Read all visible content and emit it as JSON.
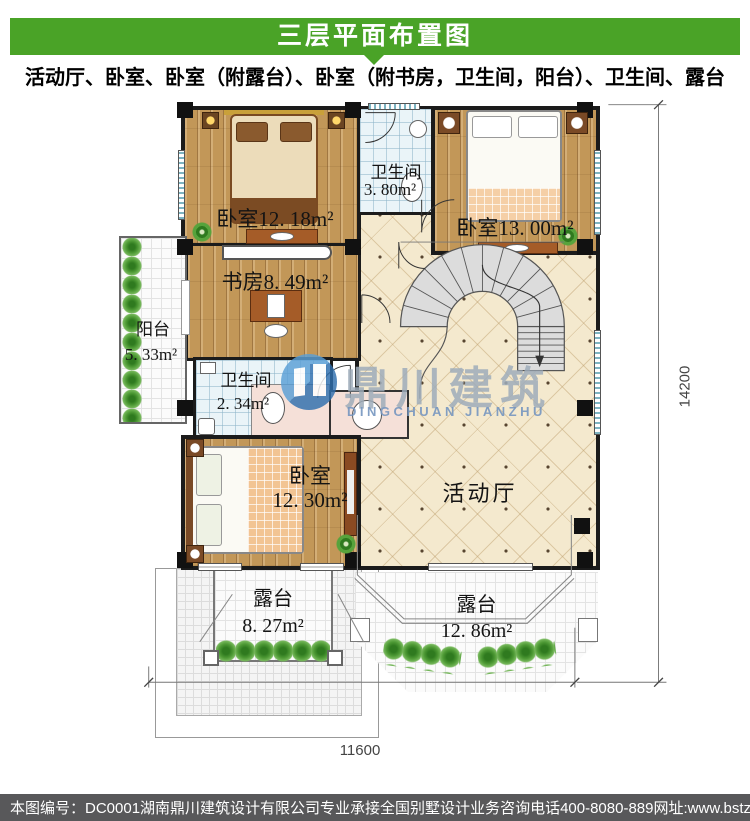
{
  "header": {
    "title": "三层平面布置图"
  },
  "subtitle": "活动厅、卧室、卧室（附露台）、卧室（附书房，卫生间，阳台）、卫生间、露台",
  "plan": {
    "rooms": {
      "bedroom_top_left": {
        "label": "卧室12. 18m²"
      },
      "bathroom_top": {
        "name": "卫生间",
        "area": "3. 80m²"
      },
      "bedroom_top_right": {
        "label": "卧室13. 00m²"
      },
      "study": {
        "label": "书房8. 49m²"
      },
      "balcony": {
        "name": "阳台",
        "area": "5. 33m²"
      },
      "bathroom_middle": {
        "name": "卫生间",
        "area": "2. 34m²"
      },
      "bedroom_bottom": {
        "name": "卧室",
        "area": "12. 30m²"
      },
      "hall": {
        "name": "活动厅"
      },
      "terrace_left": {
        "name": "露台",
        "area": "8. 27m²"
      },
      "terrace_right": {
        "name": "露台",
        "area": "12. 86m²"
      }
    },
    "dimensions": {
      "right": "14200",
      "bottom": "11600"
    }
  },
  "watermark": {
    "cn": "鼎川建筑",
    "en": "DINGCHUAN JIANZHU"
  },
  "footer": {
    "sheet_no": "本图编号：DC0001",
    "company": "湖南鼎川建筑设计有限公司专业承接全国别墅设计业务",
    "phone": "咨询电话400-8080-889",
    "website": "网址:www.bstzcs.com"
  },
  "colors": {
    "accent_green": "#4aa327",
    "footer_bg": "#58585a",
    "wood": "#c29758",
    "tile_blue": "#eaf4f8",
    "hall_cream": "#f4e9ce"
  }
}
